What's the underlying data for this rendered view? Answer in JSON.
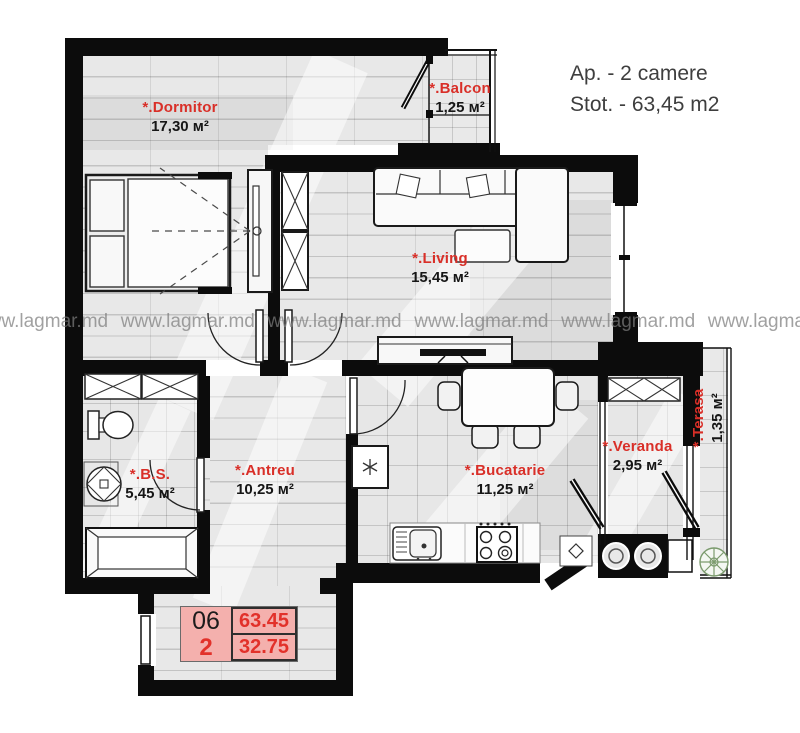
{
  "header": {
    "apartment": "Ap. - 2 camere",
    "total": "Stot. - 63,45 m2"
  },
  "watermark": {
    "text": "www.lagmar.md"
  },
  "rooms": {
    "dormitor": {
      "label": "*.Dormitor",
      "area": "17,30 м²"
    },
    "balcon": {
      "label": "*.Balcon",
      "area": "1,25 м²"
    },
    "living": {
      "label": "*.Living",
      "area": "15,45 м²"
    },
    "bs": {
      "label": "*.B.S.",
      "area": "5,45 м²"
    },
    "antreu": {
      "label": "*.Antreu",
      "area": "10,25 м²"
    },
    "bucatarie": {
      "label": "*.Bucatarie",
      "area": "11,25 м²"
    },
    "veranda": {
      "label": "*.Veranda",
      "area": "2,95 м²"
    },
    "terasa": {
      "label": "*.Terasa",
      "area": "1,35 м²"
    }
  },
  "info_table": {
    "unit": "06",
    "rooms": "2",
    "total_area": "63.45",
    "living_area": "32.75"
  },
  "colors": {
    "label_red": "#d92f28",
    "wall_black": "#0c0c0c",
    "table_pink": "#f4b0ad",
    "watermark_gray": "#7d7d7d"
  }
}
